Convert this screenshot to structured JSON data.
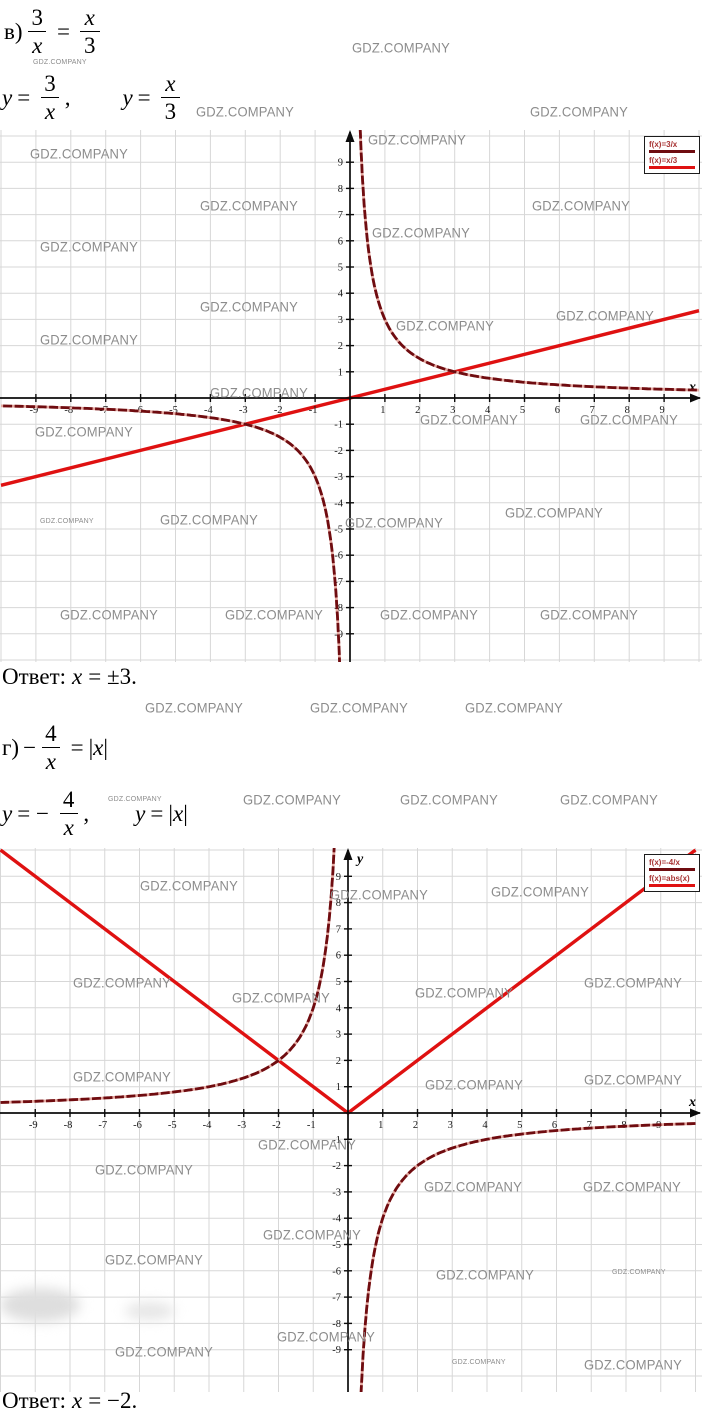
{
  "watermark_text": "GDZ.COMPANY",
  "colors": {
    "curve_dark": "#6f0c10",
    "curve_bright": "#df1111",
    "curve_underlay": "#e4a8a0",
    "grid": "#d7d7d7",
    "axis": "#0c0c0c",
    "watermark": "#8c8c8c",
    "legend_text": "#a83434"
  },
  "problems": {
    "v": {
      "label": "в)",
      "equation": {
        "num1": "3",
        "den1": "x",
        "equals": "=",
        "num2": "x",
        "den2": "3"
      },
      "defs": {
        "y1": "y",
        "eq1": "=",
        "num1": "3",
        "den1": "x",
        "comma": ",",
        "y2": "y",
        "eq2": "=",
        "num2": "x",
        "den2": "3"
      },
      "answer": {
        "label": "Ответ:",
        "variable": "x",
        "value": "= ±3."
      }
    },
    "g": {
      "label": "г)",
      "equation": {
        "minus": "−",
        "num1": "4",
        "den1": "x",
        "equals": "=",
        "abs_l": "|",
        "abs_v": "x",
        "abs_r": "|"
      },
      "defs": {
        "y1": "y",
        "eq1": "= −",
        "num1": "4",
        "den1": "x",
        "comma": ",",
        "y2": "y",
        "eq2": "=",
        "abs_l": "|",
        "abs_v": "x",
        "abs_r": "|"
      },
      "answer": {
        "label": "Ответ:",
        "variable": "x",
        "value": "= −2."
      }
    }
  },
  "chart_data": [
    {
      "type": "line",
      "title": "",
      "functions": [
        {
          "name": "f(x)=3/x",
          "kind": "hyperbola",
          "k": 3,
          "color": "#6f0c10"
        },
        {
          "name": "f(x)=x/3",
          "kind": "linear",
          "slope": 0.3333,
          "intercept": 0,
          "color": "#df1111"
        }
      ],
      "xlim": [
        -10,
        10
      ],
      "ylim": [
        -10,
        10
      ],
      "x_ticks": [
        -9,
        -8,
        -7,
        -6,
        -5,
        -4,
        -3,
        -2,
        -1,
        1,
        2,
        3,
        4,
        5,
        6,
        7,
        8,
        9
      ],
      "y_ticks": [
        -9,
        -8,
        -7,
        -6,
        -5,
        -4,
        -3,
        -2,
        -1,
        1,
        2,
        3,
        4,
        5,
        6,
        7,
        8,
        9
      ],
      "x_axis_label": "x",
      "y_axis_label": "",
      "grid": true,
      "legend_position": "top-right",
      "intersections": [
        [
          3,
          1
        ],
        [
          -3,
          -1
        ]
      ],
      "solution_x": "±3"
    },
    {
      "type": "line",
      "title": "",
      "functions": [
        {
          "name": "f(x)=-4/x",
          "kind": "hyperbola",
          "k": -4,
          "color": "#6f0c10"
        },
        {
          "name": "f(x)=abs(x)",
          "kind": "abs",
          "color": "#df1111"
        }
      ],
      "xlim": [
        -10,
        10
      ],
      "ylim": [
        -10,
        10
      ],
      "x_ticks": [
        -9,
        -8,
        -7,
        -6,
        -5,
        -4,
        -3,
        -2,
        -1,
        1,
        2,
        3,
        4,
        5,
        6,
        7,
        8,
        9
      ],
      "y_ticks": [
        -9,
        -8,
        -7,
        -6,
        -5,
        -4,
        -3,
        -2,
        -1,
        1,
        2,
        3,
        4,
        5,
        6,
        7,
        8,
        9
      ],
      "x_axis_label": "x",
      "y_axis_label": "y",
      "grid": true,
      "legend_position": "top-right",
      "intersections": [
        [
          -2,
          2
        ]
      ],
      "solution_x": "-2"
    }
  ],
  "watermarks": [
    {
      "x": 352,
      "y": 40,
      "s": "m"
    },
    {
      "x": 33,
      "y": 59,
      "s": "xs"
    },
    {
      "x": 196,
      "y": 104,
      "s": "m"
    },
    {
      "x": 530,
      "y": 104,
      "s": "m"
    },
    {
      "x": 30,
      "y": 146,
      "s": "m"
    },
    {
      "x": 368,
      "y": 132,
      "s": "m"
    },
    {
      "x": 200,
      "y": 198,
      "s": "m"
    },
    {
      "x": 532,
      "y": 198,
      "s": "m"
    },
    {
      "x": 40,
      "y": 239,
      "s": "m"
    },
    {
      "x": 372,
      "y": 225,
      "s": "m"
    },
    {
      "x": 200,
      "y": 299,
      "s": "m"
    },
    {
      "x": 396,
      "y": 318,
      "s": "m"
    },
    {
      "x": 556,
      "y": 308,
      "s": "m"
    },
    {
      "x": 40,
      "y": 332,
      "s": "m"
    },
    {
      "x": 210,
      "y": 385,
      "s": "m"
    },
    {
      "x": 35,
      "y": 424,
      "s": "m"
    },
    {
      "x": 420,
      "y": 412,
      "s": "m"
    },
    {
      "x": 580,
      "y": 412,
      "s": "m"
    },
    {
      "x": 40,
      "y": 518,
      "s": "xs"
    },
    {
      "x": 160,
      "y": 512,
      "s": "m"
    },
    {
      "x": 345,
      "y": 515,
      "s": "m"
    },
    {
      "x": 505,
      "y": 505,
      "s": "m"
    },
    {
      "x": 60,
      "y": 607,
      "s": "m"
    },
    {
      "x": 225,
      "y": 607,
      "s": "m"
    },
    {
      "x": 380,
      "y": 607,
      "s": "m"
    },
    {
      "x": 540,
      "y": 607,
      "s": "m"
    },
    {
      "x": 145,
      "y": 700,
      "s": "m"
    },
    {
      "x": 310,
      "y": 700,
      "s": "m"
    },
    {
      "x": 465,
      "y": 700,
      "s": "m"
    },
    {
      "x": 108,
      "y": 796,
      "s": "xs"
    },
    {
      "x": 243,
      "y": 792,
      "s": "m"
    },
    {
      "x": 400,
      "y": 792,
      "s": "m"
    },
    {
      "x": 560,
      "y": 792,
      "s": "m"
    },
    {
      "x": 140,
      "y": 878,
      "s": "m"
    },
    {
      "x": 330,
      "y": 887,
      "s": "m"
    },
    {
      "x": 491,
      "y": 884,
      "s": "m"
    },
    {
      "x": 73,
      "y": 975,
      "s": "m"
    },
    {
      "x": 232,
      "y": 990,
      "s": "m"
    },
    {
      "x": 415,
      "y": 985,
      "s": "m"
    },
    {
      "x": 584,
      "y": 975,
      "s": "m"
    },
    {
      "x": 73,
      "y": 1069,
      "s": "m"
    },
    {
      "x": 425,
      "y": 1077,
      "s": "m"
    },
    {
      "x": 584,
      "y": 1072,
      "s": "m"
    },
    {
      "x": 258,
      "y": 1137,
      "s": "m"
    },
    {
      "x": 95,
      "y": 1162,
      "s": "m"
    },
    {
      "x": 424,
      "y": 1179,
      "s": "m"
    },
    {
      "x": 583,
      "y": 1179,
      "s": "m"
    },
    {
      "x": 263,
      "y": 1227,
      "s": "m"
    },
    {
      "x": 105,
      "y": 1252,
      "s": "m"
    },
    {
      "x": 436,
      "y": 1267,
      "s": "m"
    },
    {
      "x": 612,
      "y": 1269,
      "s": "xs"
    },
    {
      "x": 277,
      "y": 1329,
      "s": "m"
    },
    {
      "x": 115,
      "y": 1344,
      "s": "m"
    },
    {
      "x": 452,
      "y": 1359,
      "s": "xs"
    },
    {
      "x": 584,
      "y": 1357,
      "s": "m"
    }
  ]
}
